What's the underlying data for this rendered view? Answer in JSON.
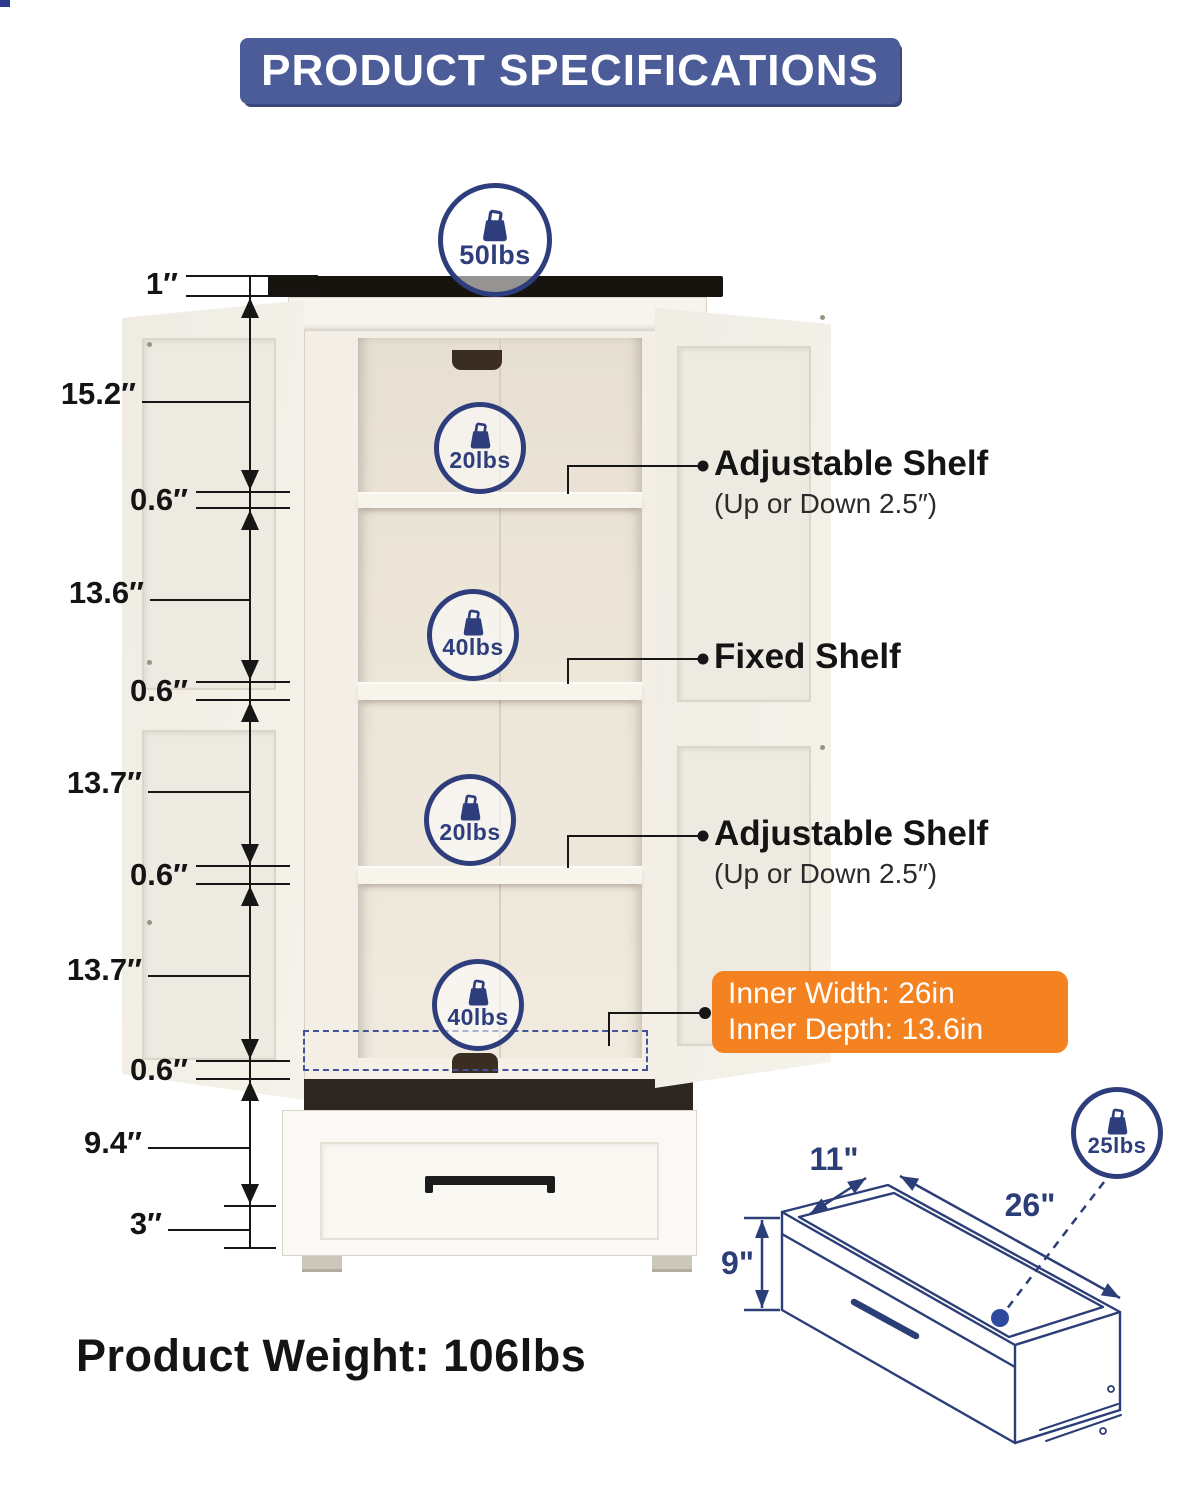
{
  "title": "PRODUCT SPECIFICATIONS",
  "colors": {
    "banner_blue": "#4c5c99",
    "accent_navy": "#2e3e7c",
    "highlight_orange": "#f58220"
  },
  "badges": [
    {
      "id": "top",
      "label": "50lbs"
    },
    {
      "id": "shelf-1",
      "label": "20lbs"
    },
    {
      "id": "shelf-2",
      "label": "40lbs"
    },
    {
      "id": "shelf-3",
      "label": "20lbs"
    },
    {
      "id": "shelf-4",
      "label": "40lbs"
    },
    {
      "id": "drawer",
      "label": "25lbs"
    }
  ],
  "dimensions_left": [
    {
      "label": "1″"
    },
    {
      "label": "15.2″"
    },
    {
      "label": "0.6″"
    },
    {
      "label": "13.6″"
    },
    {
      "label": "0.6″"
    },
    {
      "label": "13.7″"
    },
    {
      "label": "0.6″"
    },
    {
      "label": "13.7″"
    },
    {
      "label": "0.6″"
    },
    {
      "label": "9.4″"
    },
    {
      "label": "3″"
    }
  ],
  "callouts": {
    "adjustable_top": {
      "title": "Adjustable Shelf",
      "subtitle": "(Up or Down 2.5″)"
    },
    "fixed_shelf": {
      "title": "Fixed Shelf"
    },
    "adjustable_bottom": {
      "title": "Adjustable Shelf",
      "subtitle": "(Up or Down 2.5″)"
    },
    "inner_dimensions": {
      "line1": "Inner Width: 26in",
      "line2": "Inner Depth: 13.6in"
    }
  },
  "drawer_diagram": {
    "depth": "11\"",
    "width": "26\"",
    "height": "9\""
  },
  "footer": {
    "product_weight": "Product Weight: 106lbs"
  }
}
